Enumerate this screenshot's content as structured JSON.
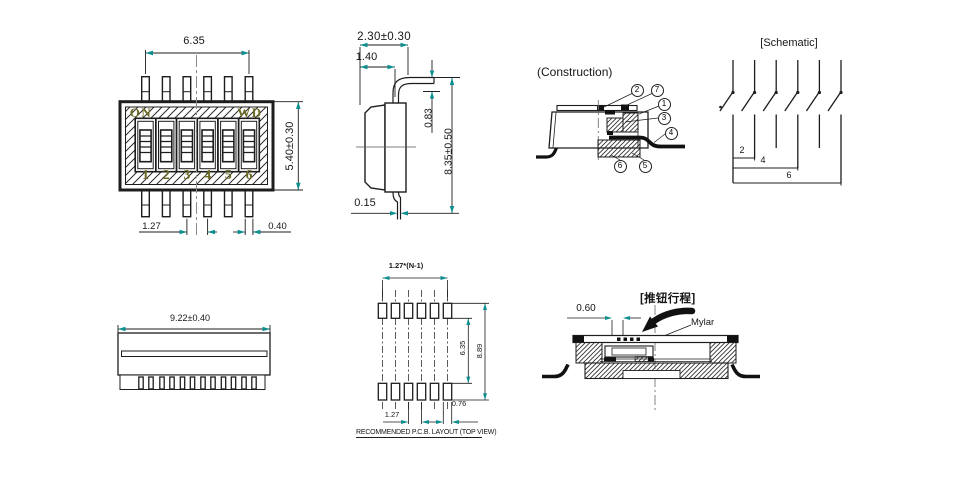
{
  "drawing": {
    "top_view": {
      "dim_top_width": "6.35",
      "dim_height": "5.40±0.30",
      "dim_pitch": "1.27",
      "dim_pin_width": "0.40",
      "label_on": "ON",
      "label_wd": "WD",
      "positions": [
        "1",
        "2",
        "3",
        "4",
        "5",
        "6"
      ]
    },
    "side_view": {
      "dim_depth": "2.30±0.30",
      "dim_body_depth": "1.40",
      "dim_lead_height": "0.83",
      "dim_overall_width": "8.35±0.50",
      "dim_lead_thickness": "0.15"
    },
    "construction": {
      "title": "(Construction)",
      "callouts": [
        "1",
        "2",
        "3",
        "4",
        "5",
        "6",
        "7"
      ]
    },
    "schematic": {
      "title": "[Schematic]",
      "position_labels": [
        "2",
        "4",
        "6"
      ]
    },
    "front_view": {
      "dim_overall_length": "9.22±0.40"
    },
    "pcb_layout": {
      "dim_total_pitch": "1.27*(N-1)",
      "dim_pad_inner_span": "6.35",
      "dim_pad_outer_span": "8.89",
      "dim_pitch": "1.27",
      "dim_pad_width": "0.76",
      "caption": "RECOMMENDED P.C.B. LAYOUT (TOP VIEW)"
    },
    "travel_view": {
      "dim_travel": "0.60",
      "label_travel": "[推钮行程]",
      "label_mylar": "Mylar"
    }
  },
  "colors": {
    "dimension_arrow": "#0e8f8f",
    "marking_text": "#6b6b23",
    "line": "#1d1d1d"
  }
}
